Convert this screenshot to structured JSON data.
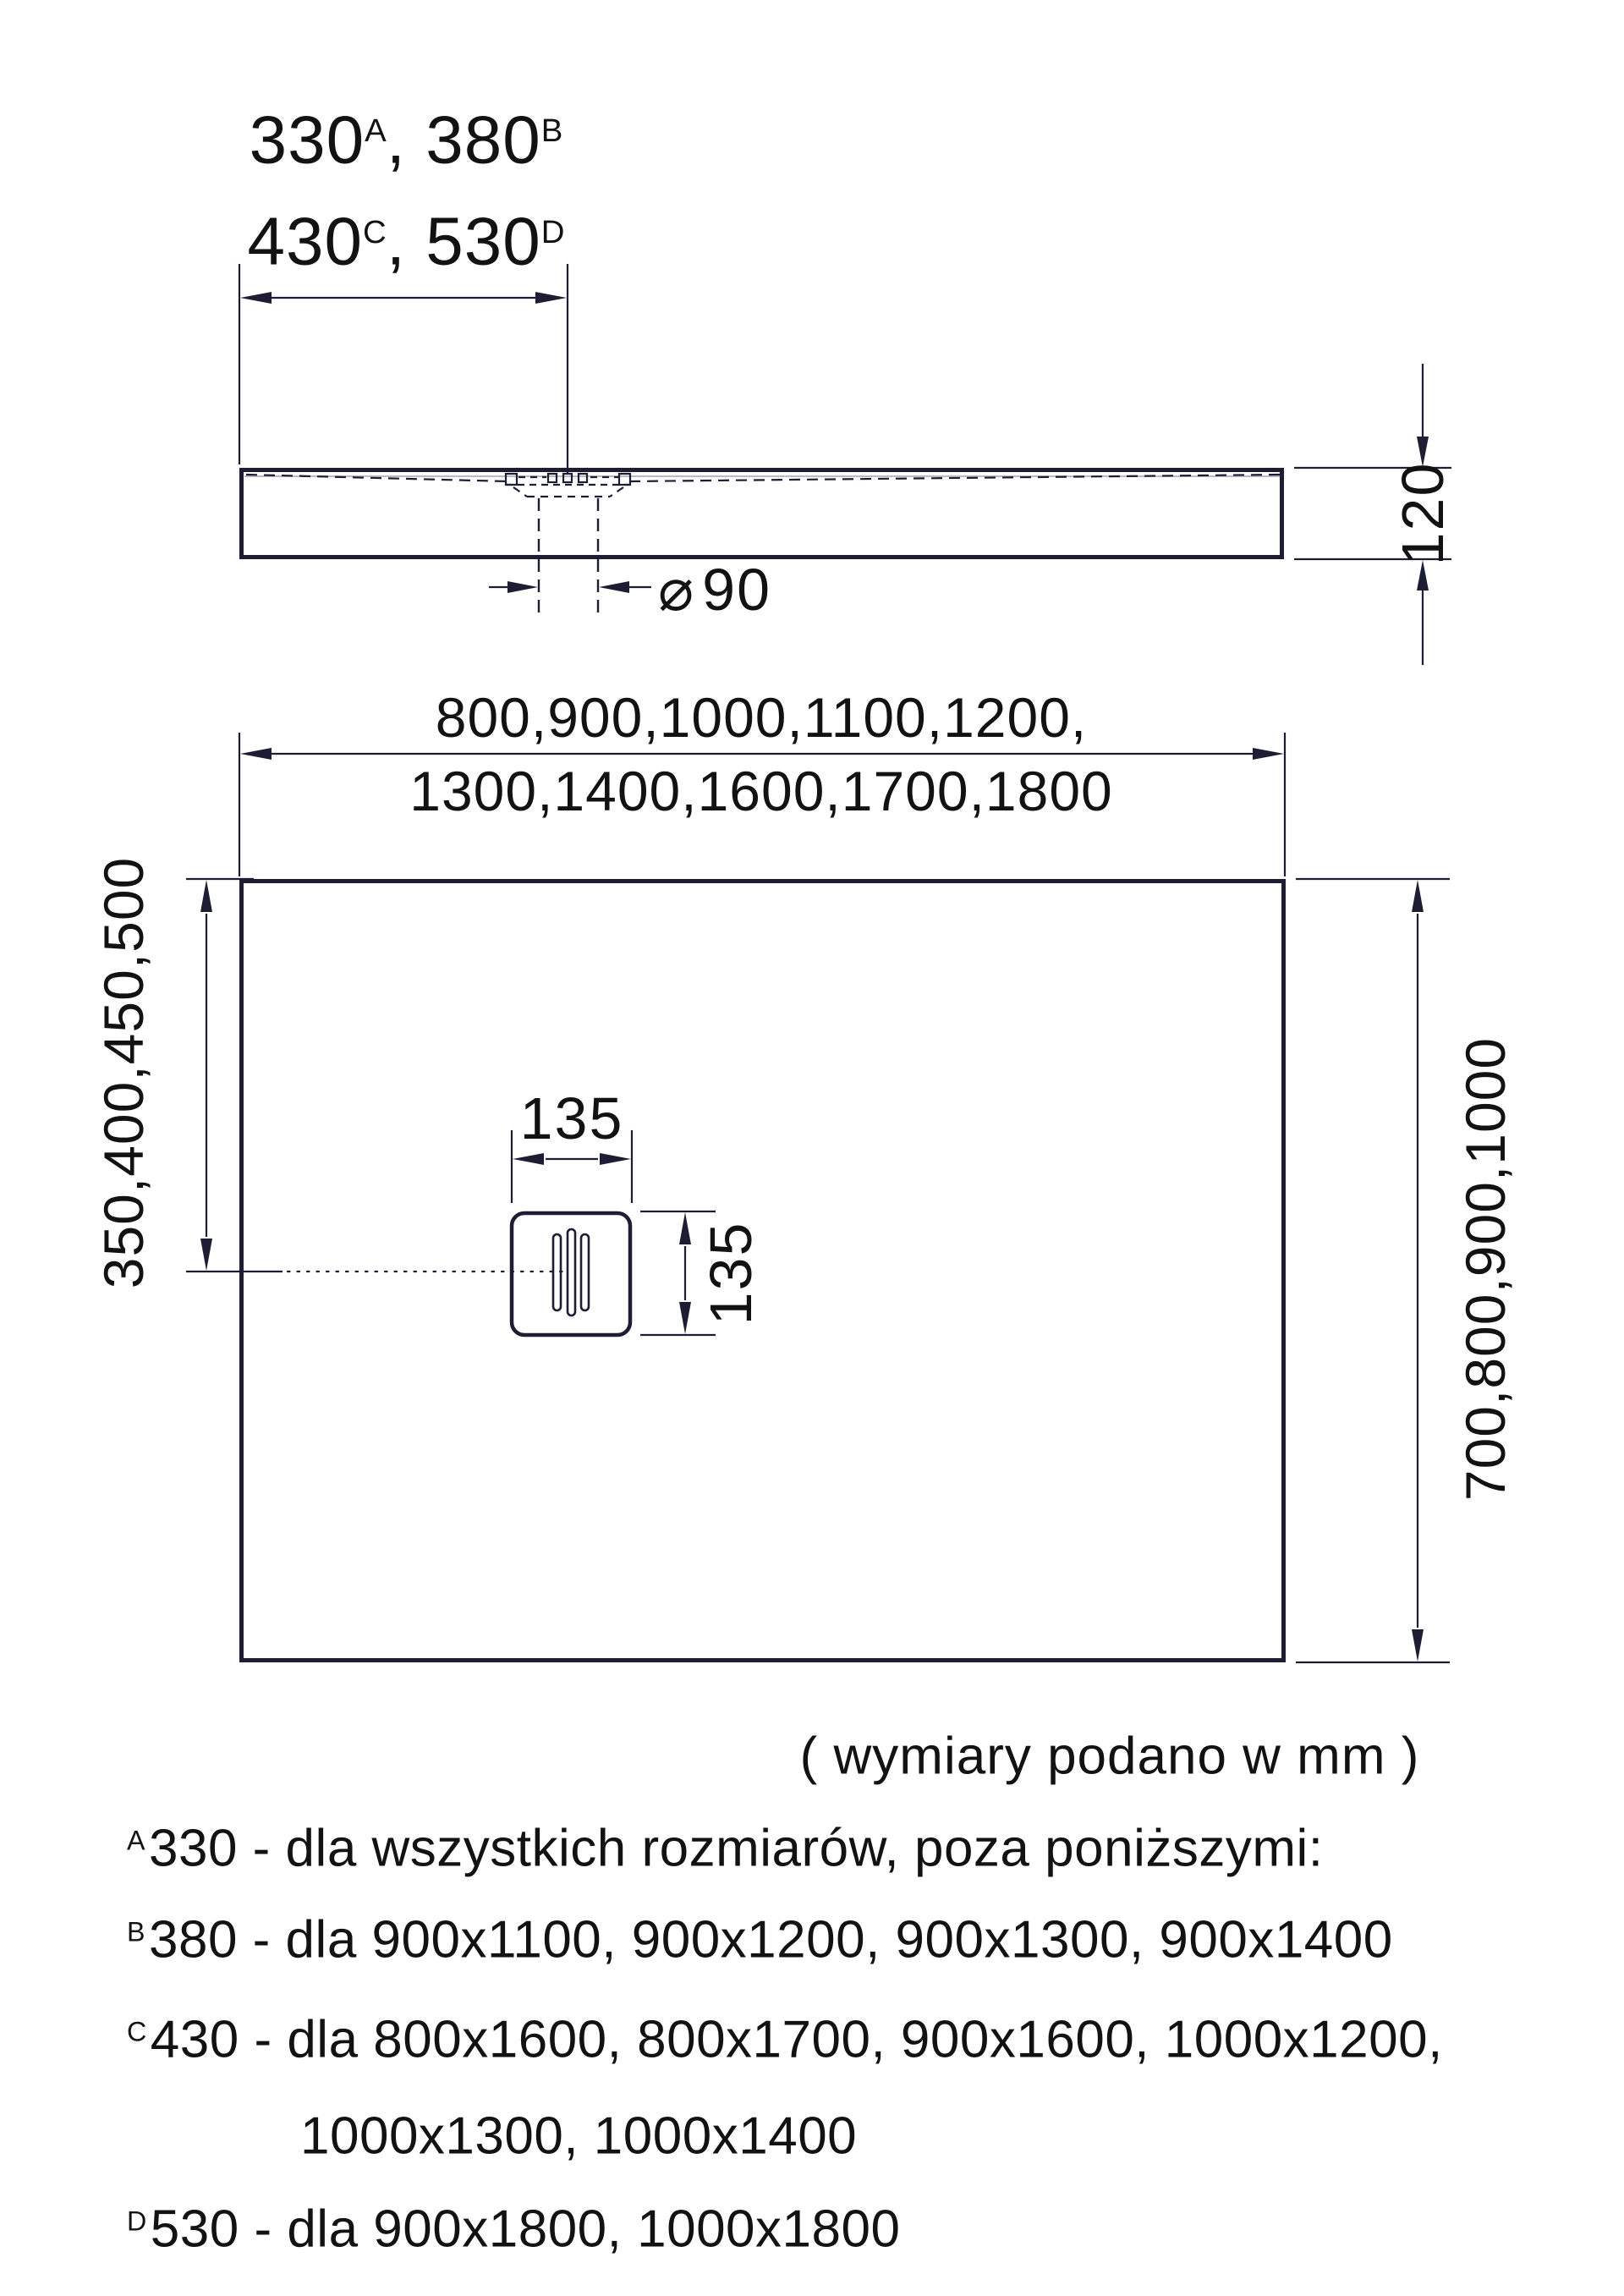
{
  "colors": {
    "line": "#1d1d33",
    "text": "#121212",
    "surface_line": "#b9bac4",
    "background": "#ffffff"
  },
  "side_view": {
    "offset_dims": {
      "v1": "330",
      "s1": "A",
      "v2": ", 380",
      "s2": "B",
      "v3": "430",
      "s3": "C",
      "v4": ", 530",
      "s4": "D"
    },
    "thickness": "120",
    "drain_diameter_symbol": "⌀",
    "drain_diameter": "90"
  },
  "plan_view": {
    "width_options_line1": "800,900,1000,1100,1200,",
    "width_options_line2": "1300,1400,1600,1700,1800",
    "drain_offset_left": "350,400,450,500",
    "depth_options": "700,800,900,1000",
    "drain_width": "135",
    "drain_height": "135"
  },
  "note": "( wymiary podano w mm )",
  "footnotes": [
    {
      "sup": "A",
      "text": "330 - dla wszystkich rozmiarów, poza poniższymi:"
    },
    {
      "sup": "B",
      "text": "380 - dla 900x1100, 900x1200, 900x1300, 900x1400"
    },
    {
      "sup": "C",
      "text": "430 - dla 800x1600, 800x1700, 900x1600, 1000x1200,"
    },
    {
      "sup": "",
      "text": "1000x1300, 1000x1400"
    },
    {
      "sup": "D",
      "text": "530 - dla 900x1800, 1000x1800"
    }
  ]
}
